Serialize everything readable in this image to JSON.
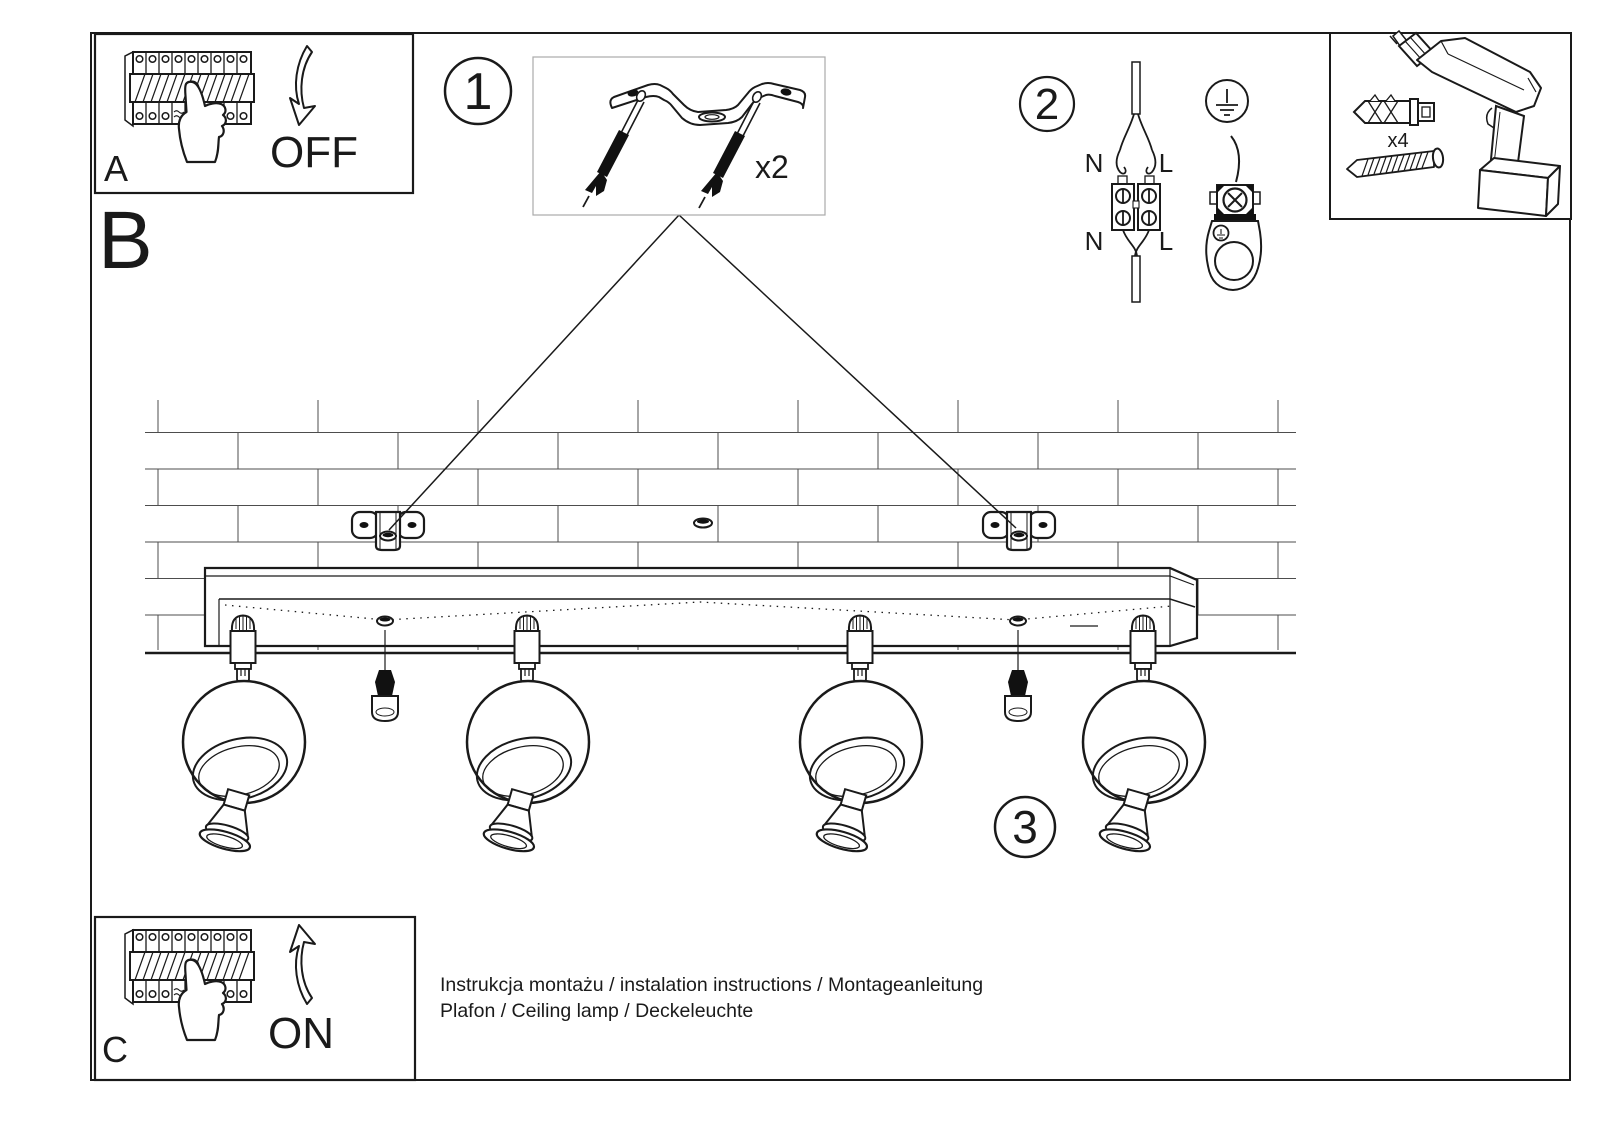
{
  "panel_a": {
    "label": "A",
    "action": "OFF"
  },
  "panel_c": {
    "label": "C",
    "action": "ON"
  },
  "section_b": {
    "label": "B"
  },
  "step1": {
    "number": "1",
    "quantity": "x2"
  },
  "step2": {
    "number": "2",
    "wire_labels": {
      "top_n": "N",
      "top_l": "L",
      "bottom_n": "N",
      "bottom_l": "L"
    }
  },
  "step3": {
    "number": "3"
  },
  "toolbox": {
    "anchor_quantity": "x4"
  },
  "footer": {
    "line1": "Instrukcja montażu / instalation instructions / Montageanleitung",
    "line2": "Plafon / Ceiling lamp / Deckeleuchte"
  },
  "colors": {
    "ink": "#1a1a1a",
    "wall_line": "#4d4d4d",
    "kit_box_border": "#aaaaaa",
    "paper": "#ffffff"
  },
  "icons": {
    "circuit_breaker": "breaker-panel-icon",
    "hand": "hand-pointing-icon",
    "arrow_down": "arrow-down-icon",
    "arrow_up": "arrow-up-icon",
    "bracket": "mounting-bracket-icon",
    "screw_anchor": "screw-with-anchor-icon",
    "terminal_block": "terminal-block-icon",
    "earth": "earth-symbol-icon",
    "ground_terminal": "ground-terminal-icon",
    "drill": "drill-icon",
    "wall_plug": "wall-plug-icon",
    "screw": "screw-icon",
    "ceiling_rail": "ceiling-rail-icon",
    "spotlight": "spotlight-icon"
  }
}
